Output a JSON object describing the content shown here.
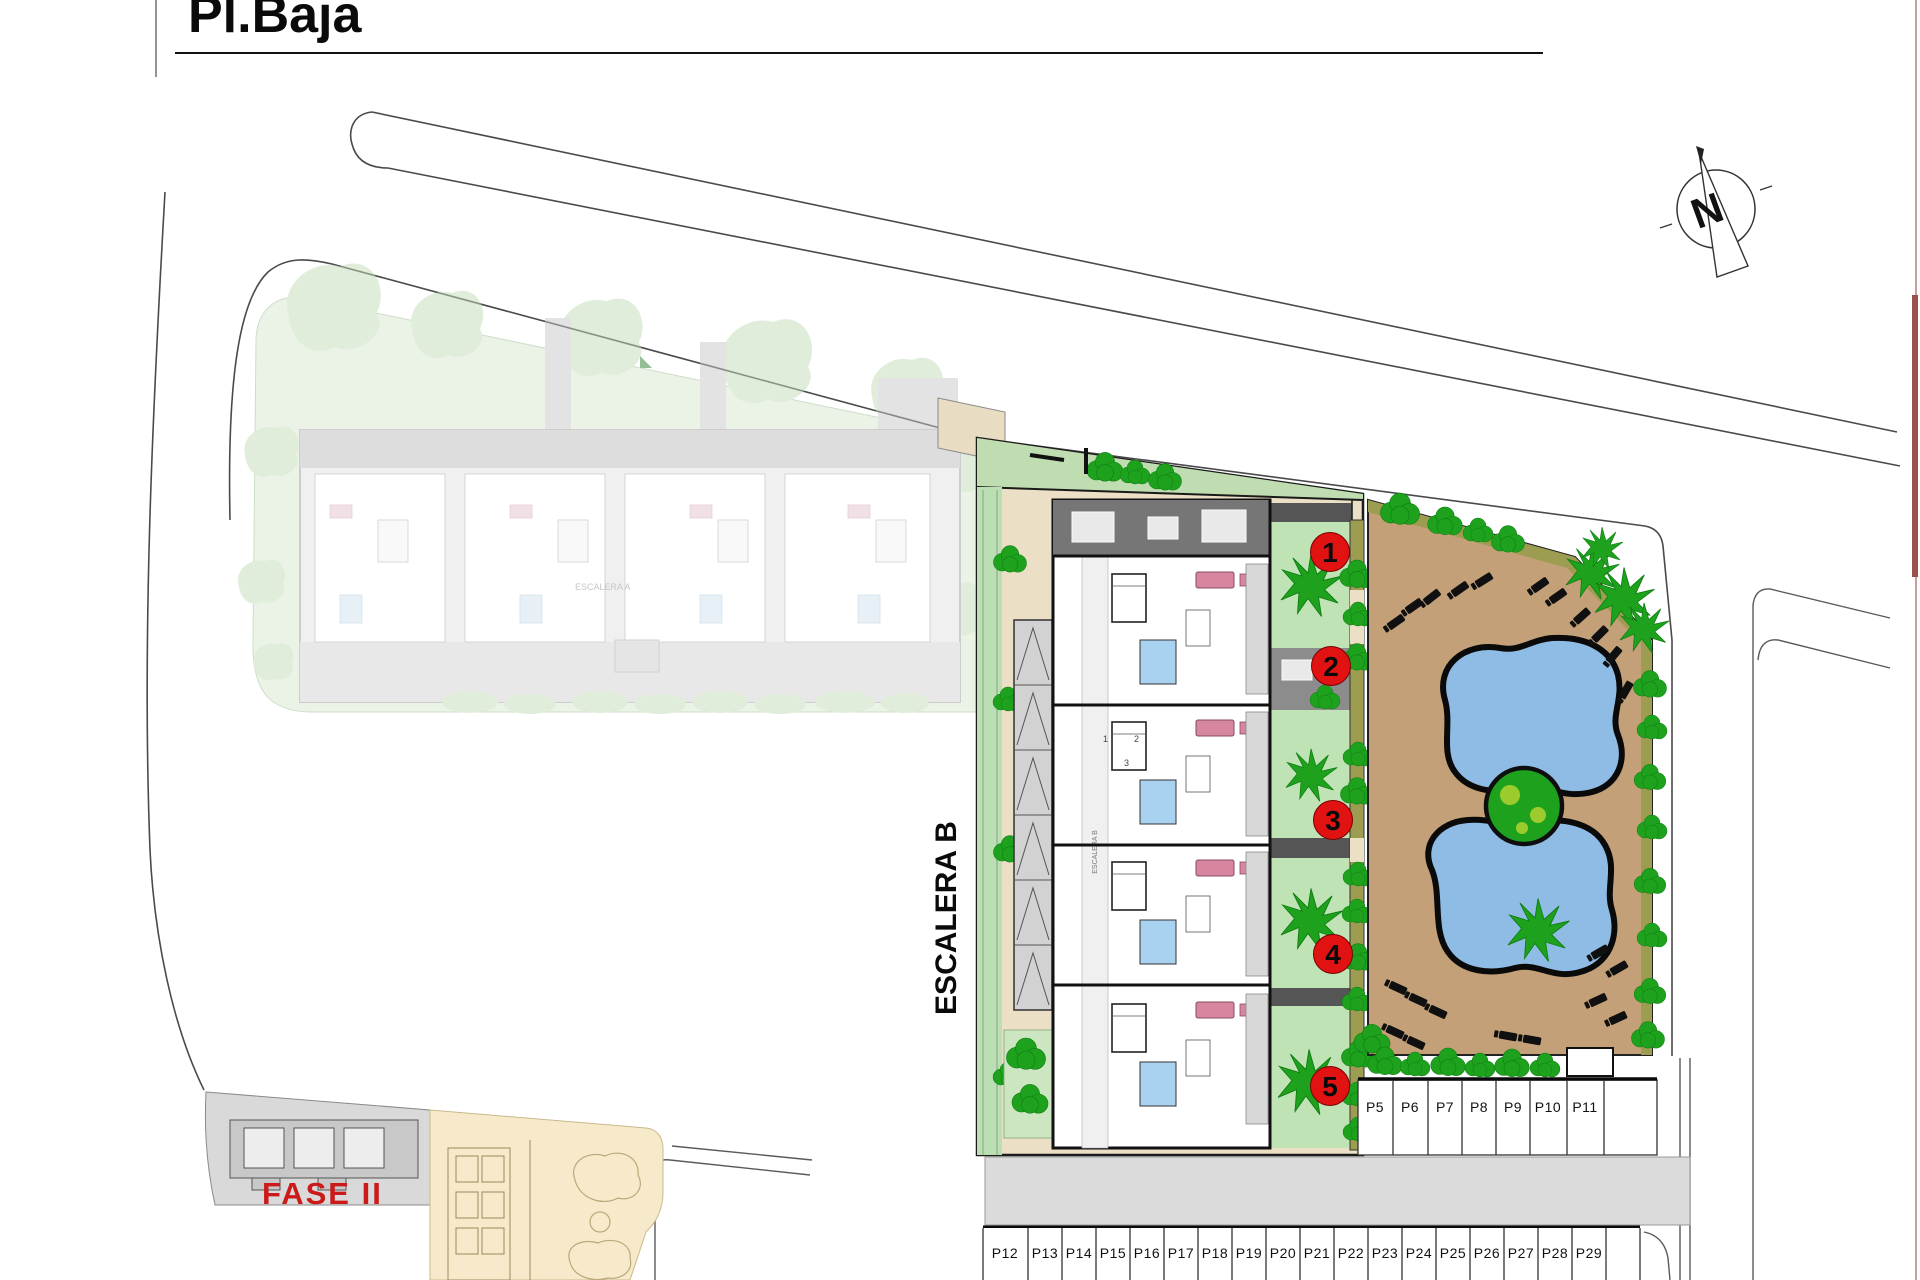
{
  "page": {
    "title": "Pl.Baja"
  },
  "plan": {
    "building_label_main": "ESCALERA B",
    "building_label_inner": "ESCALERA B",
    "faded_building_label": "ESCALERA A",
    "phase_label": "FASE II",
    "compass_letter": "N",
    "unit_markers": [
      "1",
      "2",
      "3",
      "4",
      "5"
    ],
    "unit_plan_numbers": [
      "1",
      "2",
      "3"
    ],
    "parking_upper": [
      "P5",
      "P6",
      "P7",
      "P8",
      "P9",
      "P10",
      "P11"
    ],
    "parking_lower": [
      "P12",
      "P13",
      "P14",
      "P15",
      "P16",
      "P17",
      "P18",
      "P19",
      "P20",
      "P21",
      "P22",
      "P23",
      "P24",
      "P25",
      "P26",
      "P27",
      "P28",
      "P29"
    ],
    "colors": {
      "plot_cream": "#EBDFC5",
      "deck_tan": "#C3A077",
      "pool_blue": "#8FBCE4",
      "garden_green": "#BFE3B5",
      "strip_green": "#BCDEB4",
      "wedge_green": "#BFDDB0",
      "faded_green": "#D8E8D0",
      "tree_green": "#1EA21E",
      "olive": "#9D9D52",
      "terrace_gray": "#767676",
      "road_gray": "#DBDBDB",
      "bath_blue": "#A8D2F0",
      "sofa_pink": "#D786A0",
      "marker_red": "#E11212",
      "phase_red": "#CC1A1A",
      "keyplan_yellow": "#F6EACB",
      "keyplan_gray": "#D9D9D9",
      "frame_maroon": "#9B5050"
    }
  }
}
